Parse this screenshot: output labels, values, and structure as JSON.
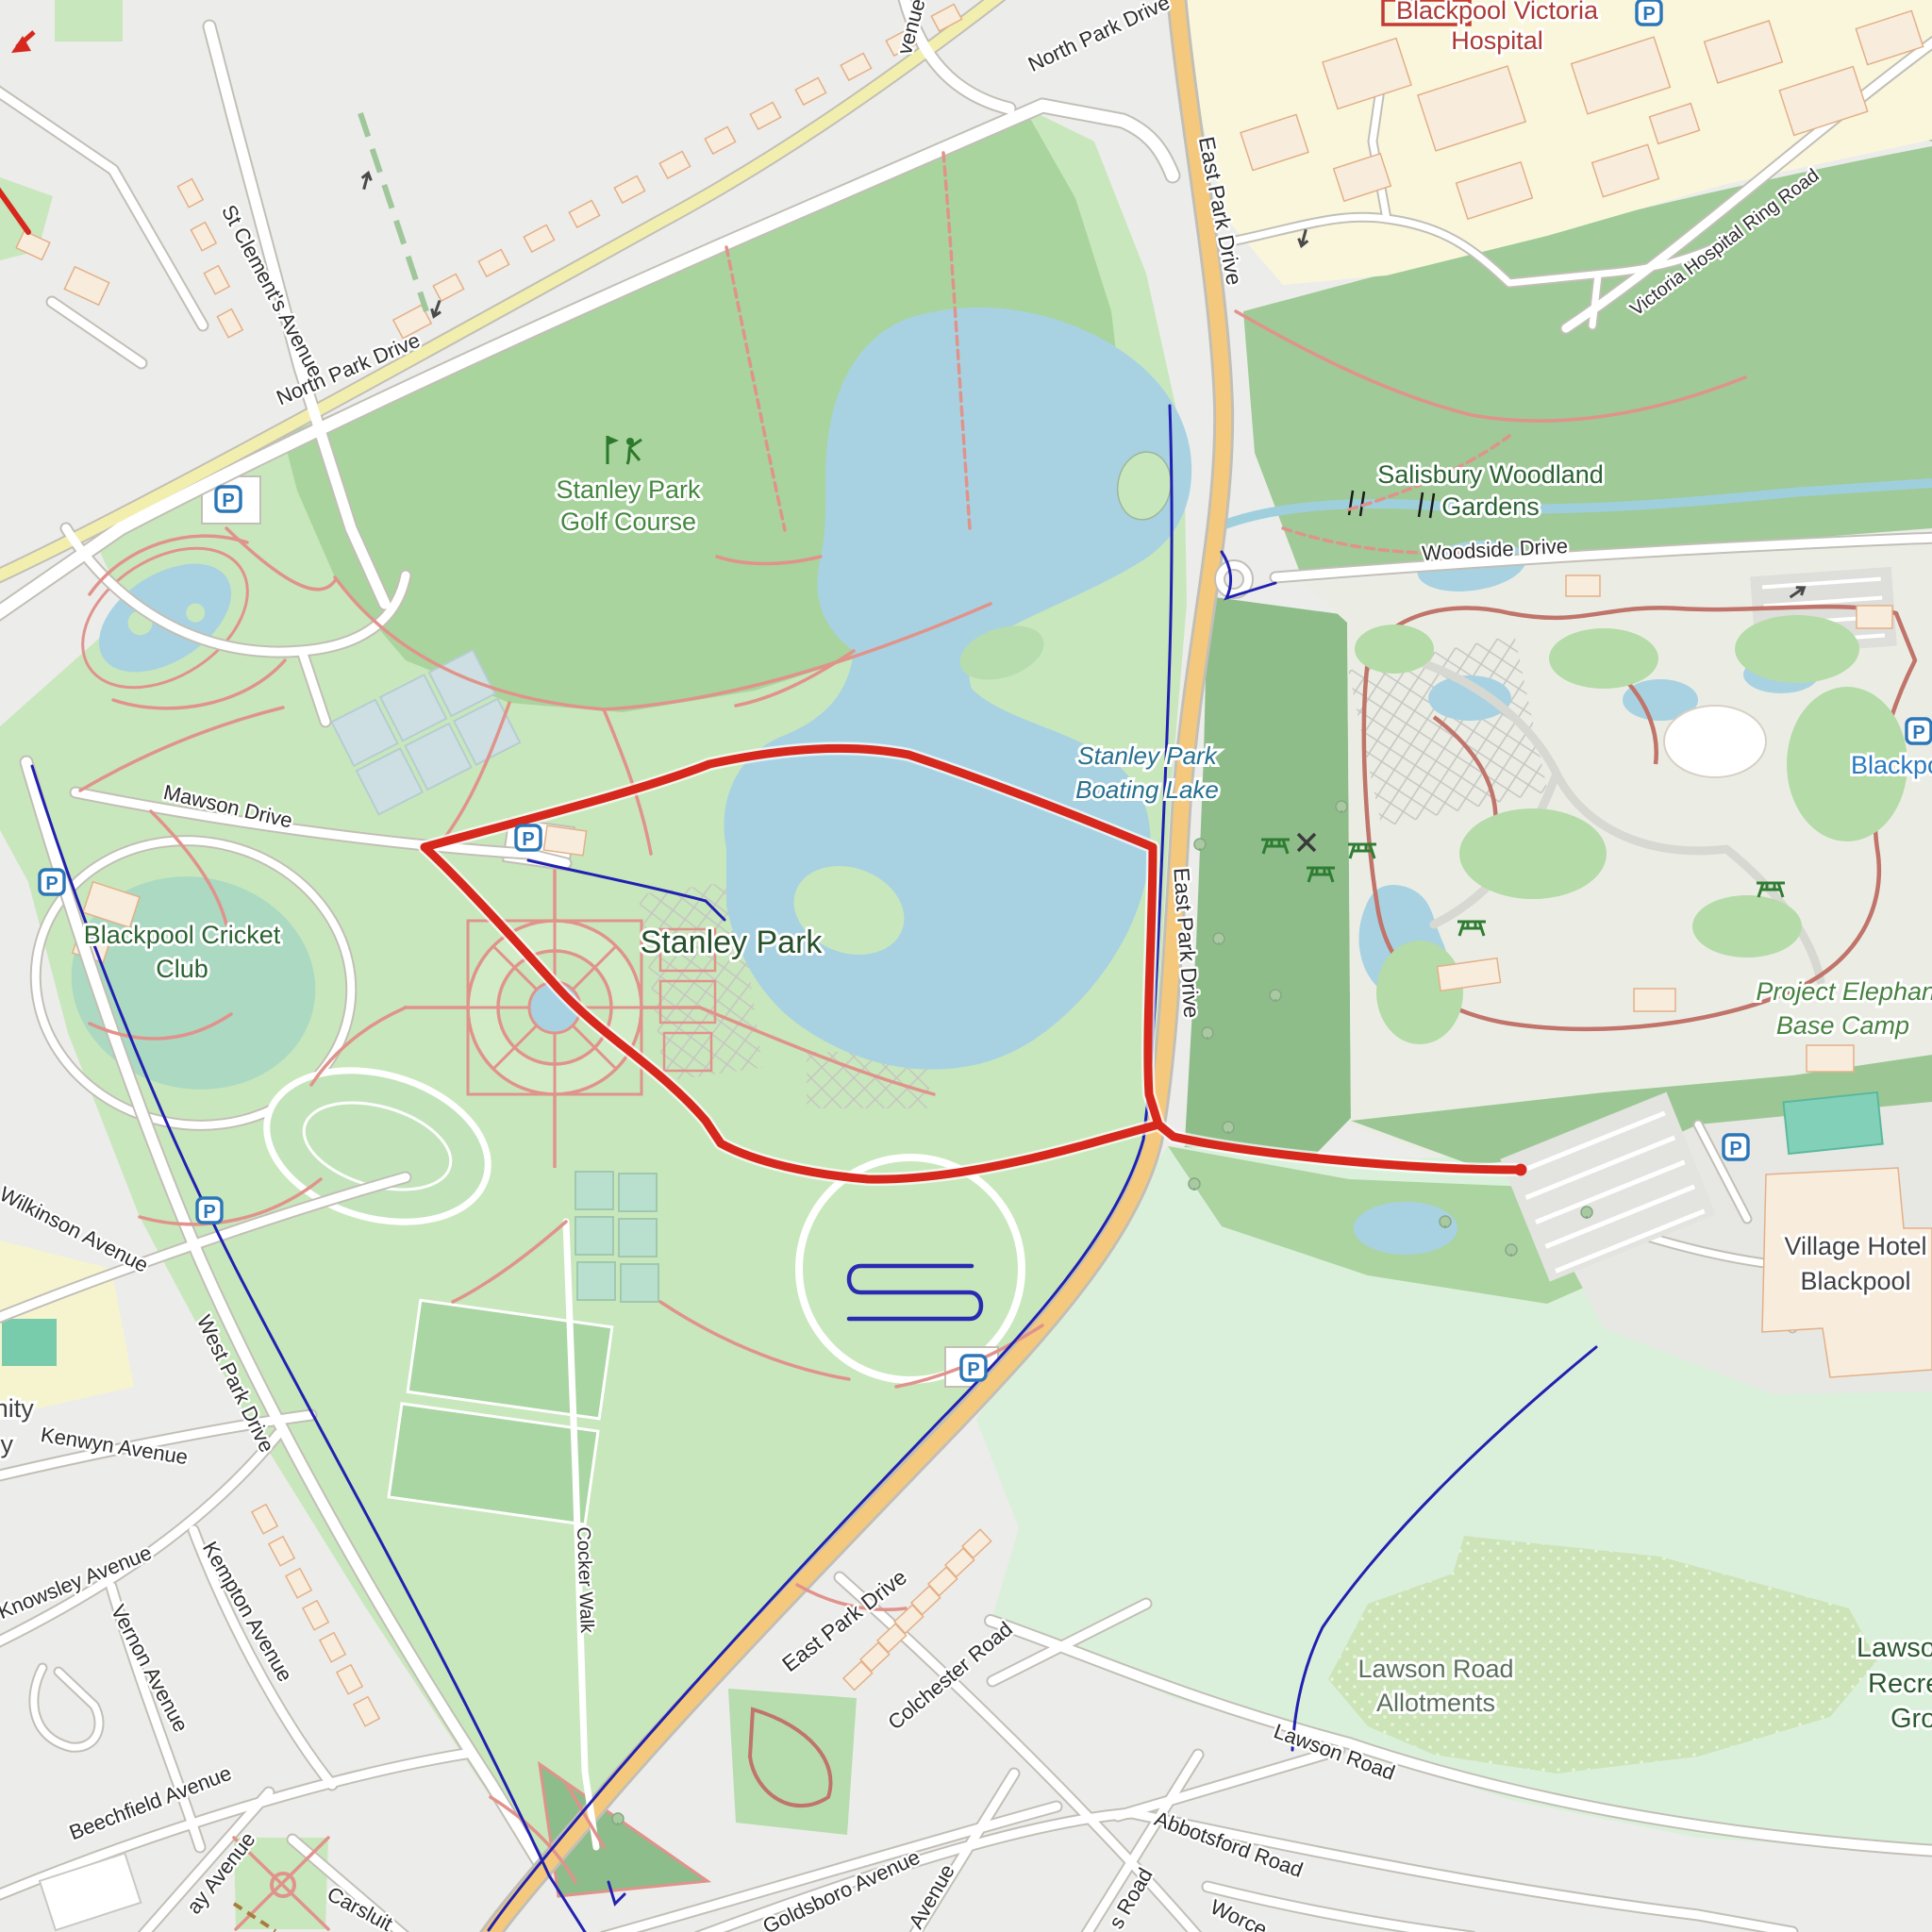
{
  "map_meta": {
    "style": "openstreetmap-carto",
    "area": "Stanley Park, Blackpool with GPS route overlay"
  },
  "colors": {
    "route_red": "#d7281e",
    "water_blue": "#a8d2e2",
    "park_green": "#c9e7bc",
    "golf_green": "#a9d49d",
    "woodland_green": "#9cc795",
    "primary_road_orange": "#f5c97d",
    "hospital_grounds_yellow": "#f9f6dc",
    "parking_blue": "#2b76b7",
    "cycle_route_blue": "#2121b0",
    "recreation_mint": "#dbf0db"
  },
  "icons": {
    "parking_letter": "P"
  },
  "place_labels": {
    "hospital": {
      "lines": [
        "Blackpool Victoria",
        "Hospital"
      ]
    },
    "salisbury_woodland_gardens": {
      "lines": [
        "Salisbury Woodland",
        "Gardens"
      ]
    },
    "stanley_park_golf_course": {
      "lines": [
        "Stanley Park",
        "Golf Course"
      ]
    },
    "stanley_park": {
      "lines": [
        "Stanley Park"
      ]
    },
    "stanley_park_boating_lake": {
      "lines": [
        "Stanley Park",
        "Boating Lake"
      ]
    },
    "blackpool_cricket_club": {
      "lines": [
        "Blackpool Cricket",
        "Club"
      ]
    },
    "village_hotel_blackpool": {
      "lines": [
        "Village Hotel",
        "Blackpool"
      ]
    },
    "project_elephant_base_camp": {
      "lines": [
        "Project Elephan",
        "Base Camp"
      ]
    },
    "blackpool_zoo_partial": {
      "lines": [
        "Blackpoo"
      ]
    },
    "lawson_road_allotments": {
      "lines": [
        "Lawson Road",
        "Allotments"
      ]
    },
    "lawson_recreation_ground_partial": {
      "lines": [
        "Lawso",
        "Recre",
        "Gro"
      ]
    },
    "community_academy_partial": {
      "lines": [
        "munity",
        "my"
      ]
    }
  },
  "road_labels": {
    "north_park_drive": "North Park Drive",
    "st_clements_avenue": "St Clement's Avenue",
    "east_park_drive": "East Park Drive",
    "victoria_hospital_ring_road": "Victoria Hospital Ring Road",
    "woodside_drive": "Woodside Drive",
    "mawson_drive": "Mawson Drive",
    "wilkinson_avenue": "Wilkinson Avenue",
    "west_park_drive": "West Park Drive",
    "kenwyn_avenue": "Kenwyn Avenue",
    "knowsley_avenue": "Knowsley Avenue",
    "vernon_avenue": "Vernon Avenue",
    "kempton_avenue": "Kempton Avenue",
    "beechfield_avenue": "Beechfield Avenue",
    "cocker_walk": "Cocker Walk",
    "colchester_road": "Colchester Road",
    "goldsboro_avenue": "Goldsboro Avenue",
    "lawson_road": "Lawson Road",
    "abbotsford_road": "Abbotsford Road",
    "carsluith_partial": "Carsluit",
    "worcester_partial": "Worce",
    "s_road_partial": "s Road",
    "avenue_partial": "Avenue",
    "venue_partial": "venue",
    "ay_avenue_partial": "ay Avenue"
  }
}
